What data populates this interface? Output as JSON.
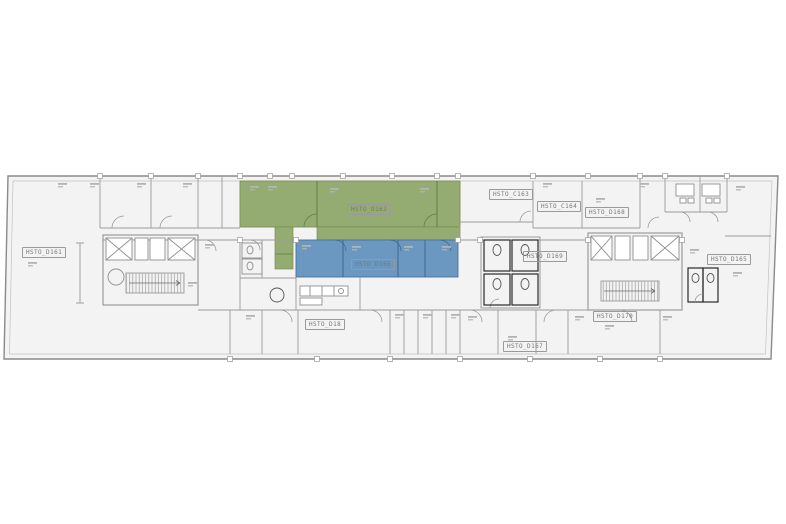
{
  "plan": {
    "type": "architectural-floor-plan",
    "colors": {
      "highlight_green": "#94ac71",
      "highlight_green_stroke": "#6f8a4a",
      "highlight_blue": "#6a98c0",
      "highlight_blue_stroke": "#46719c",
      "wall": "#9b9b9b",
      "floor": "#f3f3f3",
      "annotation": "#b3b3b3",
      "fixture_black": "#2a2a2a"
    },
    "labels": [
      {
        "id": "d161",
        "text": "HSTO_D161",
        "highlight": "none"
      },
      {
        "id": "d162",
        "text": "HSTO_D162",
        "highlight": "green"
      },
      {
        "id": "c163",
        "text": "HSTO_C163",
        "highlight": "none"
      },
      {
        "id": "c164",
        "text": "HSTO_C164",
        "highlight": "none"
      },
      {
        "id": "d168",
        "text": "HSTO_D168",
        "highlight": "none"
      },
      {
        "id": "d169",
        "text": "HSTO_D169",
        "highlight": "none"
      },
      {
        "id": "d165",
        "text": "HSTO_D165",
        "highlight": "none"
      },
      {
        "id": "d166",
        "text": "HSTO_D166",
        "highlight": "blue"
      },
      {
        "id": "d18",
        "text": "HSTO_D18",
        "highlight": "none"
      },
      {
        "id": "d170",
        "text": "HSTO_D170",
        "highlight": "none"
      },
      {
        "id": "d167",
        "text": "HSTO_D167",
        "highlight": "none"
      }
    ]
  }
}
